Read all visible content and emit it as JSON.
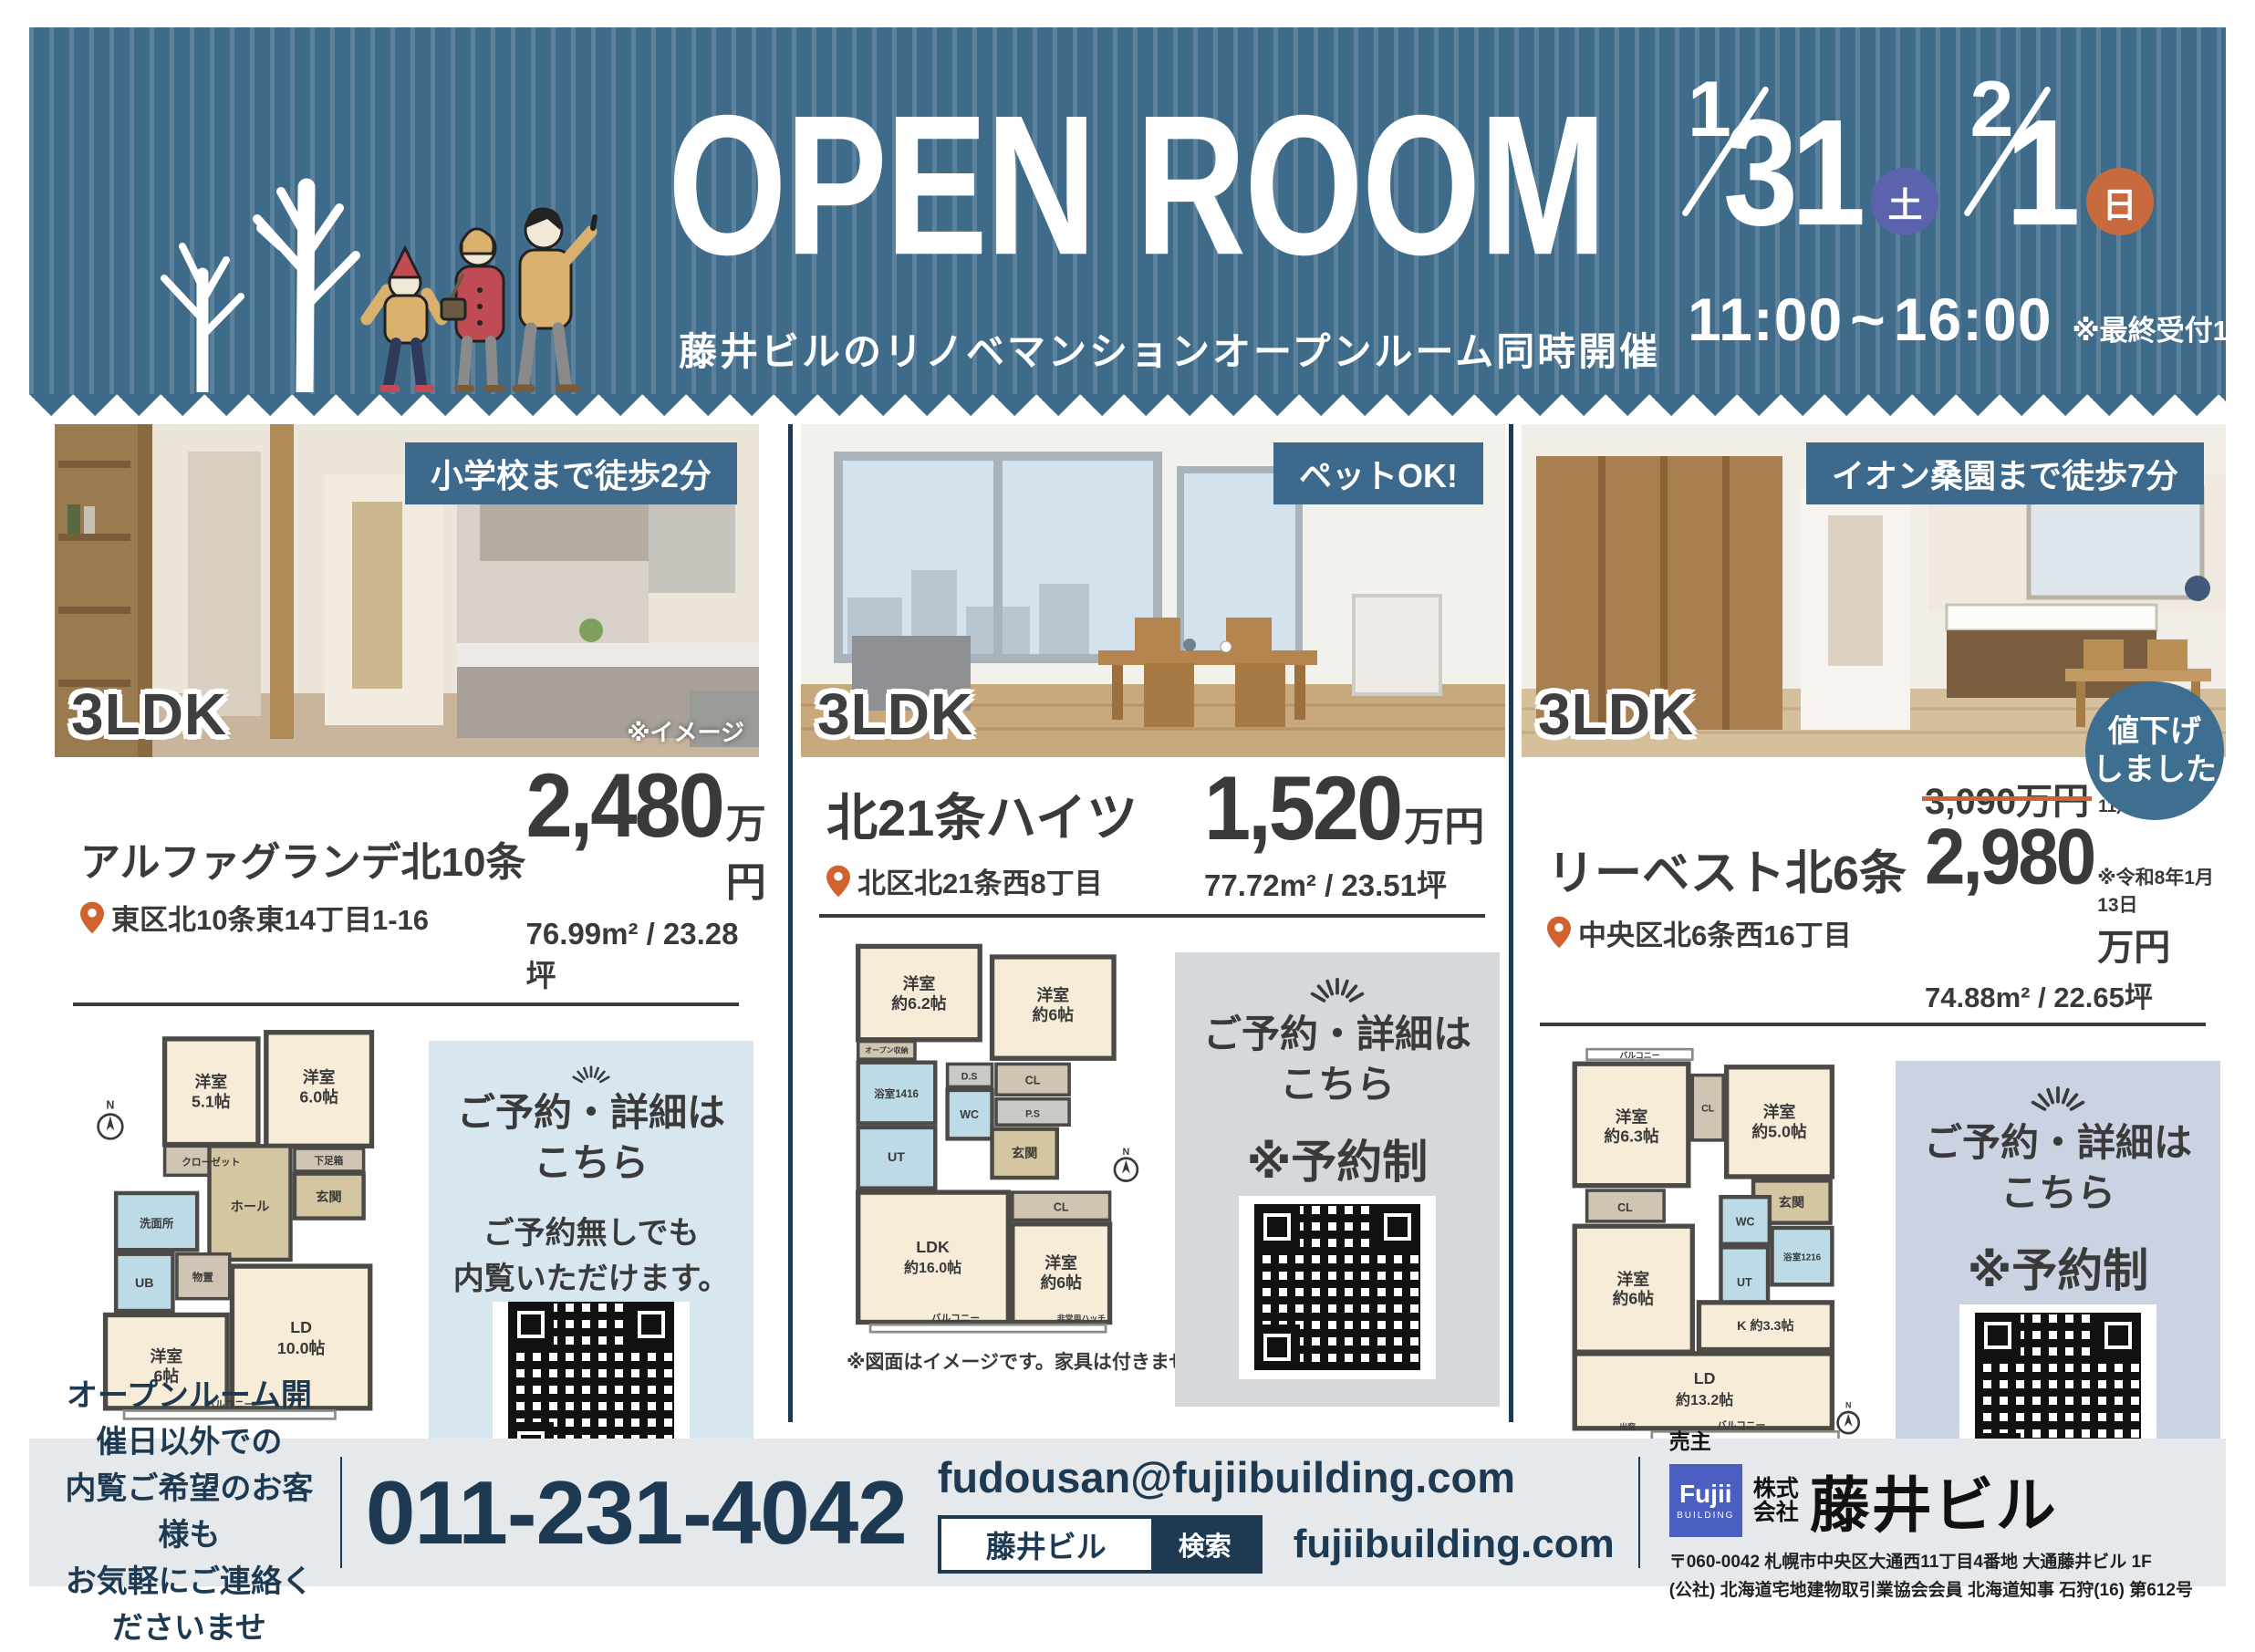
{
  "header": {
    "title": "OPEN ROOM",
    "subtitle": "藤井ビルのリノベマンションオープンルーム同時開催",
    "dates": [
      {
        "month": "1",
        "day": "31",
        "weekday": "土"
      },
      {
        "month": "2",
        "day": "1",
        "weekday": "日"
      }
    ],
    "time_start": "11:00",
    "time_sep": "~",
    "time_end": "16:00",
    "time_note": "※最終受付15:30"
  },
  "properties": [
    {
      "badge": "小学校まで徒歩2分",
      "layout": "3LDK",
      "photo_note": "※イメージ",
      "name": "アルファグランデ北10条",
      "address": "東区北10条東14丁目1-16",
      "price": "2,480",
      "price_unit": "万円",
      "area": "76.99m² / 23.28坪",
      "reserve": {
        "line1": "ご予約・詳細は",
        "line2": "こちら",
        "note1": "ご予約無しでも",
        "note2": "内覧いただけます。"
      },
      "plan": {
        "caption": "※図面はイメージです。家具は付きません。",
        "labels": [
          "洋室",
          "5.1帖",
          "洋室",
          "6.0帖",
          "クローゼット",
          "下足箱",
          "玄関",
          "ホール",
          "洗面所",
          "UB",
          "物置",
          "洋室",
          "6帖",
          "LD",
          "10.0帖",
          "バルコニー",
          "N"
        ]
      }
    },
    {
      "badge": "ペットOK!",
      "layout": "3LDK",
      "name": "北21条ハイツ",
      "address": "北区北21条西8丁目",
      "price": "1,520",
      "price_unit": "万円",
      "area": "77.72m² / 23.51坪",
      "reserve": {
        "line1": "ご予約・詳細は",
        "line2": "こちら",
        "note1": "※予約制"
      },
      "plan": {
        "caption": "※図面はイメージです。家具は付きません。",
        "labels": [
          "洋室",
          "約6.2帖",
          "洋室",
          "約6帖",
          "オープン収納",
          "浴室1416",
          "UT",
          "D.S",
          "WC",
          "CL",
          "P.S",
          "玄関",
          "LDK",
          "約16.0帖",
          "CL",
          "洋室",
          "約6帖",
          "バルコニー",
          "非常用ハッチ",
          "N"
        ]
      }
    },
    {
      "badge": "イオン桑園まで徒歩7分",
      "layout": "3LDK",
      "name": "リーベスト北6条",
      "address": "中央区北6条西16丁目",
      "price_old": "3,090万円",
      "price_old_note1": "※令和7年",
      "price_old_note2": "11月5日",
      "price": "2,980",
      "price_unit": "万円",
      "price_note": "※令和8年1月13日",
      "area": "74.88m² / 22.65坪",
      "sale_badge1": "値下げ",
      "sale_badge2": "しました",
      "reserve": {
        "line1": "ご予約・詳細は",
        "line2": "こちら",
        "note1": "※予約制"
      },
      "plan": {
        "caption": "※図面はイメージです。家具は付きません。",
        "labels": [
          "バルコニー",
          "洋室",
          "約6.3帖",
          "CL",
          "洋室",
          "約5.0帖",
          "玄関",
          "CL",
          "WC",
          "浴室1216",
          "UT",
          "洋室",
          "約6帖",
          "K 約3.3帖",
          "LD",
          "約13.2帖",
          "出窓",
          "バルコニー",
          "N"
        ]
      }
    }
  ],
  "footer": {
    "note_lines": [
      "オープンルーム開催日以外での",
      "内覧ご希望のお客様も",
      "お気軽にご連絡くださいませ"
    ],
    "phone": "011-231-4042",
    "email": "fudousan@fujiibuilding.com",
    "search_keyword": "藤井ビル",
    "search_button": "検索",
    "website": "fujiibuilding.com",
    "seller_label": "売主",
    "logo_line1": "Fujii",
    "logo_line2": "BUILDING",
    "company_prefix1": "株式",
    "company_prefix2": "会社",
    "company_name": "藤井ビル",
    "company_address1": "〒060-0042 札幌市中央区大通西11丁目4番地 大通藤井ビル 1F",
    "company_address2": "(公社) 北海道宅地建物取引業協会会員 北海道知事 石狩(16) 第612号"
  },
  "colors": {
    "header_blue": "#3f6b8b",
    "photo_badge_navy": "#3d6a8c",
    "saturday_blue": "#5b63ad",
    "sunday_orange": "#c76b3e",
    "accent_navy": "#1d3a52",
    "pin_orange": "#d2622e",
    "strike_orange": "#d2622e",
    "logo_blue": "#4b5ec1",
    "sale_badge_blue": "#3e6e90",
    "reserve_bg_1": "#d8e6f0",
    "reserve_bg_2": "#d5d9dc",
    "reserve_bg_3": "#cbd3e2",
    "footer_bg": "#e5e9ec"
  }
}
